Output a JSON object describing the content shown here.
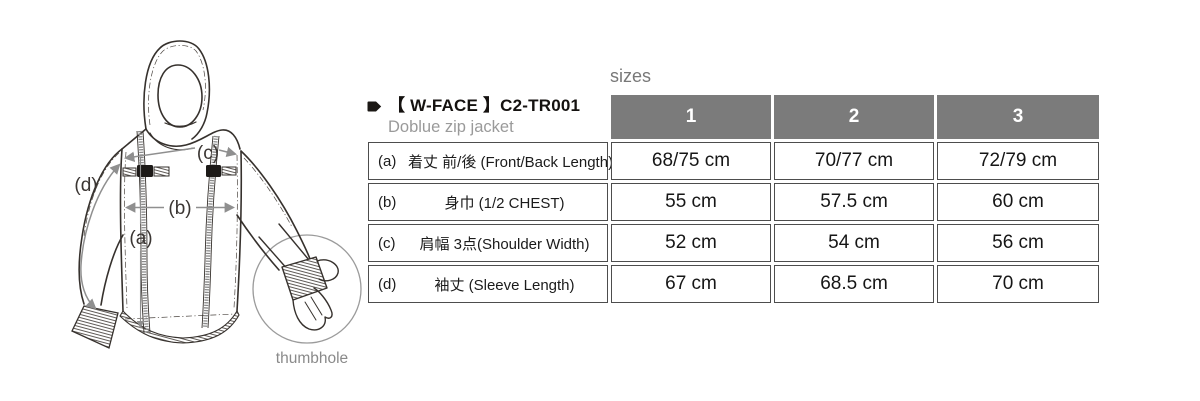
{
  "product": {
    "title": "【 W-FACE 】C2-TR001",
    "subtitle": "Doblue zip jacket"
  },
  "sizes_heading": "sizes",
  "icons": {
    "title_marker": "tag-arrow-icon"
  },
  "table": {
    "columns": [
      "1",
      "2",
      "3"
    ],
    "rows": [
      {
        "key": "(a)",
        "label": "着丈 前/後 (Front/Back Length)",
        "values": [
          "68/75 cm",
          "70/77 cm",
          "72/79 cm"
        ]
      },
      {
        "key": "(b)",
        "label": "身巾 (1/2 CHEST)",
        "values": [
          "55 cm",
          "57.5 cm",
          "60 cm"
        ]
      },
      {
        "key": "(c)",
        "label": "肩幅 3点(Shoulder Width)",
        "values": [
          "52 cm",
          "54 cm",
          "56 cm"
        ]
      },
      {
        "key": "(d)",
        "label": "袖丈 (Sleeve Length)",
        "values": [
          "67 cm",
          "68.5 cm",
          "70 cm"
        ]
      }
    ]
  },
  "diagram": {
    "labels": {
      "a": "(a)",
      "b": "(b)",
      "c": "(c)",
      "d": "(d)"
    },
    "thumbhole_label": "thumbhole"
  },
  "colors": {
    "header_bg": "#7b7b7b",
    "header_text": "#ffffff",
    "cell_border": "#4d4d4d",
    "title_text": "#151210",
    "subtitle_text": "#9a9a9a",
    "muted_label": "#8a8a8a",
    "drawing_line": "#36312d",
    "arrow": "#8f8f8f"
  }
}
